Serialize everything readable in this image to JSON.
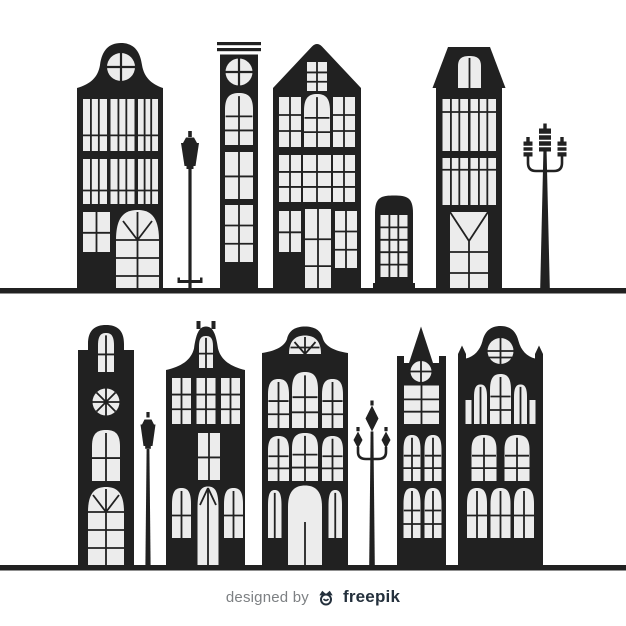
{
  "colors": {
    "ink": "#212121",
    "win": "#ececec",
    "bg": "#ffffff",
    "muted": "#7d8083",
    "brand": "#24303c"
  },
  "footer": {
    "designed_by": "designed by",
    "brand": "freepik",
    "logo_icon": "freepik-crown-icon"
  },
  "scene": {
    "description": "Two rows of flat black silhouette townhouses with light windows on white background",
    "rows": [
      {
        "name": "top-row",
        "elements": [
          "bell-gable-house",
          "street-lamp",
          "striped-tower-house",
          "pointed-gable-house",
          "phone-booth",
          "mansard-roof-house",
          "triple-street-light"
        ]
      },
      {
        "name": "bottom-row",
        "elements": [
          "round-top-tower-house",
          "street-lamp",
          "bell-gable-house",
          "curved-gable-house",
          "double-arm-street-lamp",
          "spire-clock-tower",
          "dome-gable-house"
        ]
      }
    ]
  }
}
